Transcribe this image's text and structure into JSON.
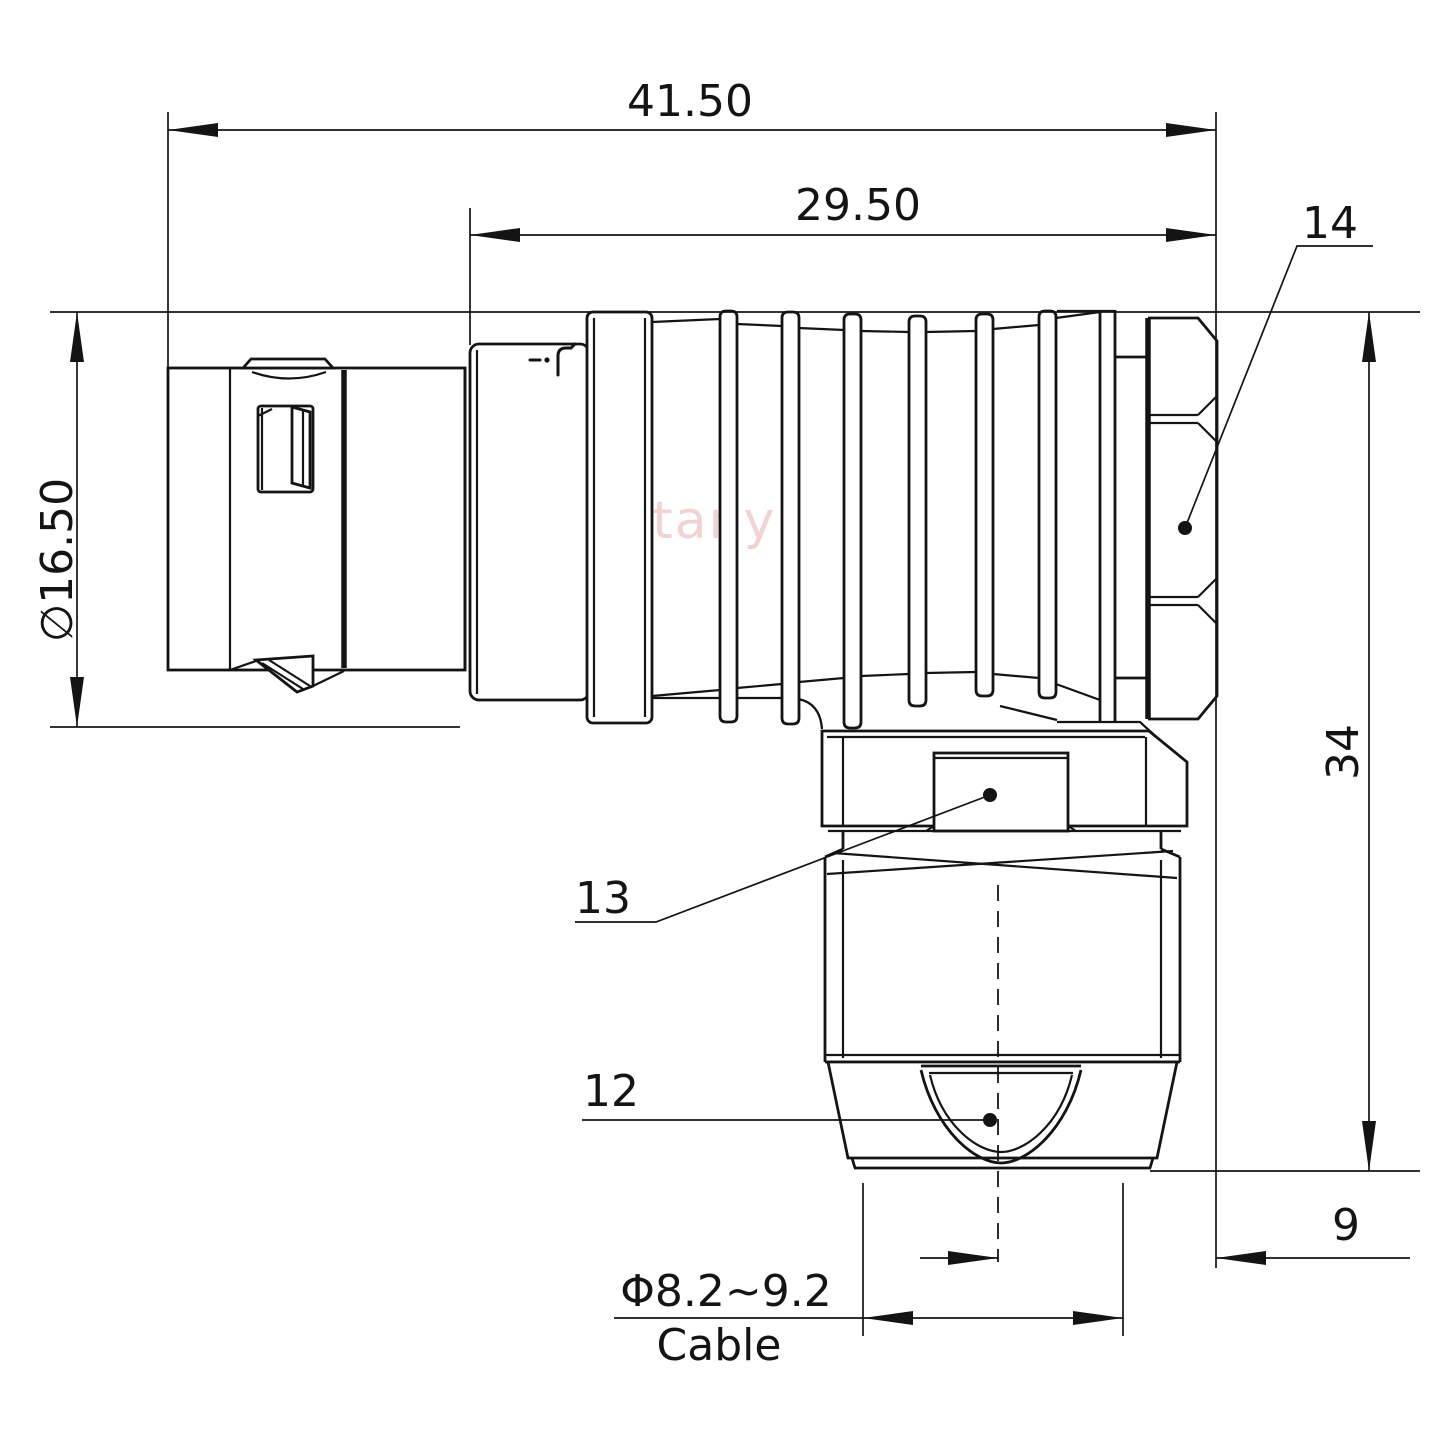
{
  "watermark": "Lightany",
  "dims": {
    "overall_length": "41.50",
    "front_length": "29.50",
    "body_diameter": "∅16.50",
    "height": "34",
    "cable_offset": "9",
    "cable_diameter": "Φ8.2~9.2",
    "cable_label": "Cable"
  },
  "labels": {
    "backnut": "14",
    "gland": "13",
    "collet": "12"
  },
  "icons": {
    "housing_marking": "lightany-logo-marks"
  }
}
